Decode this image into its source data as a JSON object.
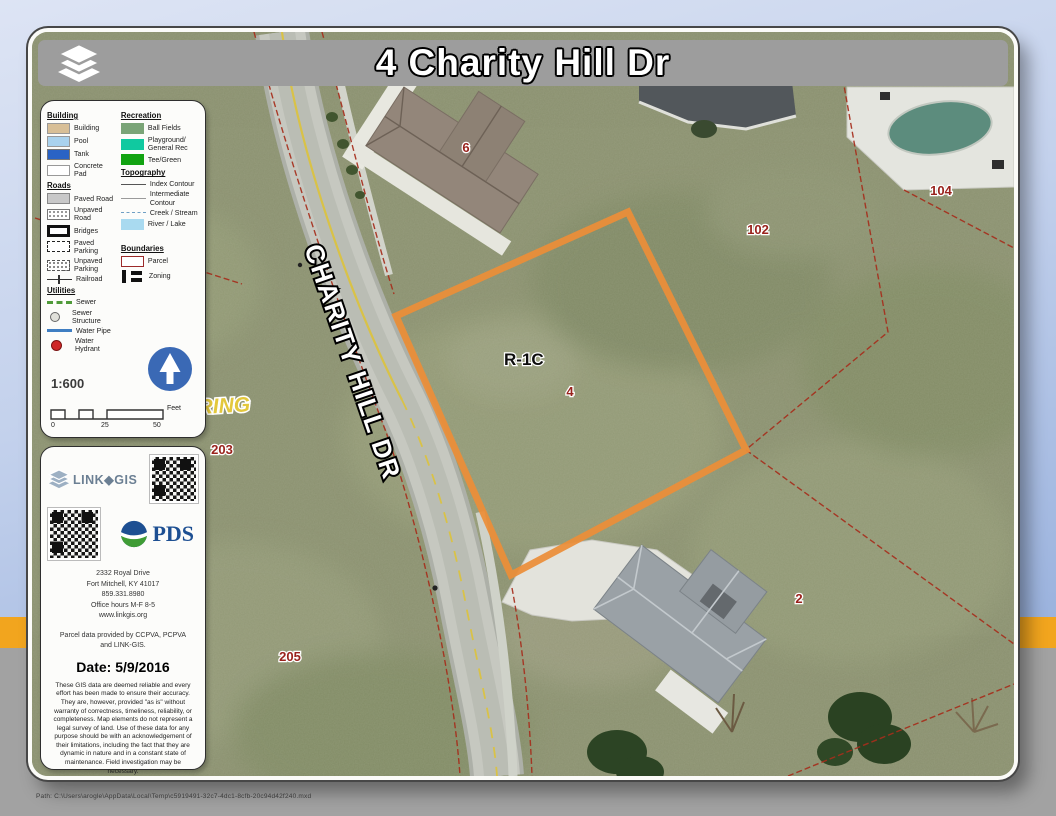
{
  "title": "4 Charity Hill Dr",
  "legend": {
    "building": {
      "header": "Building",
      "items": [
        "Building",
        "Pool",
        "Tank",
        "Concrete Pad"
      ]
    },
    "roads": {
      "header": "Roads",
      "items": [
        "Paved Road",
        "Unpaved Road",
        "Bridges",
        "Paved Parking",
        "Unpaved Parking",
        "Railroad"
      ]
    },
    "utilities": {
      "header": "Utilities",
      "items": [
        "Sewer",
        "Sewer Structure",
        "Water Pipe",
        "Water Hydrant"
      ]
    },
    "recreation": {
      "header": "Recreation",
      "items": [
        "Ball Fields",
        "Playground/ General Rec",
        "Tee/Green"
      ]
    },
    "topography": {
      "header": "Topography",
      "items": [
        "Index Contour",
        "Intermediate Contour",
        "Creek / Stream",
        "River / Lake"
      ]
    },
    "boundaries": {
      "header": "Boundaries",
      "items": [
        "Parcel",
        "Zoning"
      ]
    }
  },
  "scale": {
    "ratio": "1:600",
    "ticks": [
      "0",
      "25",
      "50"
    ],
    "unit": "Feet"
  },
  "branding": {
    "linkgis": "LINK◆GIS",
    "pds": "PDS",
    "address_lines": [
      "2332 Royal Drive",
      "Fort Mitchell, KY 41017",
      "859.331.8980",
      "Office hours M-F 8-5",
      "www.linkgis.org"
    ],
    "credit": "Parcel data provided by CCPVA, PCPVA and LINK-GIS.",
    "date": "Date: 5/9/2016",
    "disclaimer": "These GIS data are deemed reliable and every effort has been made to ensure their accuracy. They are, however, provided \"as is\" without warranty of correctness, timeliness, reliability, or completeness.  Map elements do not represent a legal survey of land. Use of these data for any purpose should be with an acknowledgement of their limitations, including the fact that they are dynamic in nature and in a constant state of maintenance. Field investigation may be necessary."
  },
  "map": {
    "road_label": "CHARITY HILL DR",
    "zoning_label": "R-1C",
    "subdivision_label": "RING",
    "parcel_labels": {
      "p4": "4",
      "p6": "6",
      "p102": "102",
      "p104": "104",
      "p203": "203",
      "p205": "205",
      "p2": "2"
    }
  },
  "footer": {
    "path": "Path: C:\\Users\\arogle\\AppData\\Local\\Temp\\c5919491-32c7-4dc1-8cfb-20c94d42f240.mxd"
  },
  "colors": {
    "parcel_highlight": "#ec8e38",
    "parcel_line": "#a62e1c",
    "title_bar": "#9d9d9d",
    "north_arrow": "#3a69b5",
    "background_stripe": "#f2a51e"
  }
}
